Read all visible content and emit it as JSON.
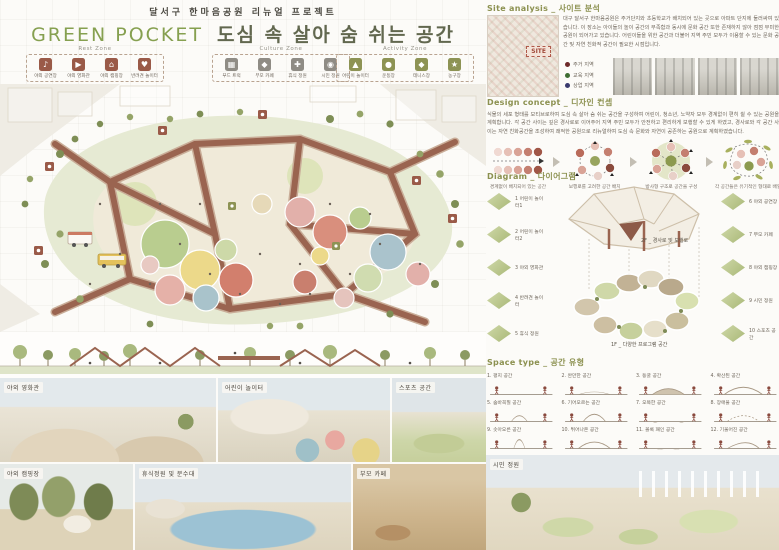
{
  "title": {
    "subtitle": "달서구 한마음공원 리뉴얼 프로젝트",
    "en": "GREEN POCKET",
    "ko": "도심 속 살아 숨 쉬는 공간"
  },
  "legend": {
    "rest": {
      "title": "Rest Zone",
      "color": "#9a5a48",
      "items": [
        {
          "glyph": "♪",
          "label": "야외 공연장"
        },
        {
          "glyph": "▶",
          "label": "야외 영화관"
        },
        {
          "glyph": "⌂",
          "label": "야외 캠핑장"
        },
        {
          "glyph": "♥",
          "label": "반려견 놀이터"
        }
      ]
    },
    "culture": {
      "title": "Culture Zone",
      "color": "#8f8c85",
      "items": [
        {
          "glyph": "▦",
          "label": "푸드 트럭"
        },
        {
          "glyph": "◆",
          "label": "부모 카페"
        },
        {
          "glyph": "✚",
          "label": "휴식 정원"
        },
        {
          "glyph": "◉",
          "label": "시민 정원"
        }
      ]
    },
    "activity": {
      "title": "Activity Zone",
      "color": "#8d9354",
      "items": [
        {
          "glyph": "▲",
          "label": "어린이 놀이터"
        },
        {
          "glyph": "●",
          "label": "운동장"
        },
        {
          "glyph": "◆",
          "label": "테니스장"
        },
        {
          "glyph": "★",
          "label": "농구장"
        }
      ]
    }
  },
  "site": {
    "header": "Site analysis _ 사이트 분석",
    "map_label": "SITE",
    "paragraph": "대구 달서구 한마음공원은 주거단지와 초등학교가 배치되어 있는 곳으로 아파트 단지에 둘러싸여 있습니다. 이 장소는 아이들의 놀이 공간의 부족함과 동시에 문화 공간 또한 존재하지 않아 점점 무미한 공원이 되어가고 있습니다. 어린이들을 위한 공간과 더불어 지역 주민 모두가 이용할 수 있는 문화 공간 및 자연 친화적 공간이 필요한 시점입니다.",
    "legend": [
      {
        "label": "주거 지역",
        "color": "#6e2a2a"
      },
      {
        "label": "교육 지역",
        "color": "#3f6d33"
      },
      {
        "label": "상업 지역",
        "color": "#3a3a6e"
      }
    ]
  },
  "concept": {
    "header": "Design concept _ 디자인 컨셉",
    "paragraph": "식물의 세포 형태를 모티브로하여 도심 속 살아 숨 쉬는 공간을 구성하여 어린이, 청소년, 노약자 모두 경계없이 편히 쉴 수 있는 공원을 계획합니다. 각 공간 사이는 깊은 경사로로 이어주어 지역 주민 모두가 안전하고 편리하게 보행할 수 있게 하였고, 경사로와 각 공간 사이는 자연 친화공간을 조성하여 쾌적한 공원으로 리뉴얼하여 도심 속 문화와 자연이 공존하는 공원으로 계획하였습니다.",
    "stages": [
      "경계없이 배치되어 있는 공간",
      "보행로를 고려한 공간 배치",
      "방사형 구조로 공간을 구성",
      "각 공간들은 유기적인 형태로 배열"
    ]
  },
  "diagram": {
    "header": "Diagram _ 다이어그램",
    "left": [
      "1 어린이 놀이터1",
      "2 어린이 놀이터2",
      "3 야외 영화관",
      "4 반려견 놀이터",
      "5 휴식 정원"
    ],
    "right": [
      "6 야외 공연장",
      "7 부모 카페",
      "8 야외 캠핑장",
      "9 시민 정원",
      "10 스포츠 공간"
    ],
    "floor2": "2F _ 경사로 및 보행로",
    "floor1": "1F _ 다양한 프로그램 공간"
  },
  "space": {
    "header": "Space type _ 공간 유형",
    "items": [
      "1. 평지 공간",
      "2. 완만한 공간",
      "3. 동굴 공간",
      "4. 확산된 공간",
      "5. 숨바꼭질 공간",
      "6. 기어오르는 공간",
      "7. 오목한 공간",
      "8. 장애물 공간",
      "9. 솟아오른 공간",
      "10. 튀어나온 공간",
      "11. 볼록 패인 공간",
      "12. 기울어진 공간"
    ]
  },
  "renders": {
    "row1": [
      "야외 영화관",
      "어린이 놀이터",
      "스포츠 공간"
    ],
    "row2": [
      "야외 캠핑장",
      "휴식정원 및 분수대",
      "부모 카페"
    ],
    "hero": "시민 정원"
  },
  "colors": {
    "accent_green": "#8c9150",
    "path_brown": "#9a6450"
  }
}
